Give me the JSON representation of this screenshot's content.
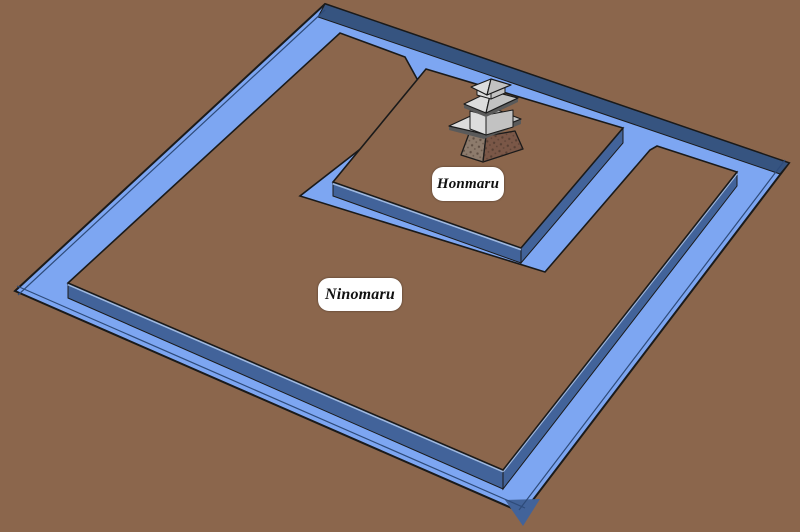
{
  "diagram": {
    "type": "castle-layout-3d",
    "labels": {
      "honmaru": "Honmaru",
      "ninomaru": "Ninomaru"
    },
    "colors": {
      "ground": "#8B664C",
      "water": "#7DA6F2",
      "water_lip": "#2E4B7A",
      "moat_far_wall": "#365480",
      "platform_wall": "#42639A",
      "wall_highlight": "#9FB8DF",
      "outline": "#1A1A1A",
      "label_bg": "#FFFFFF",
      "label_text": "#111111",
      "roof_light": "#DCDCDC",
      "roof_mid": "#C2C2C2",
      "eave_shadow": "#5A5A5A",
      "tower_base_left": "#8D7B6C",
      "tower_base_right": "#7A5747",
      "tower_speckle": "#3C2D24"
    }
  }
}
